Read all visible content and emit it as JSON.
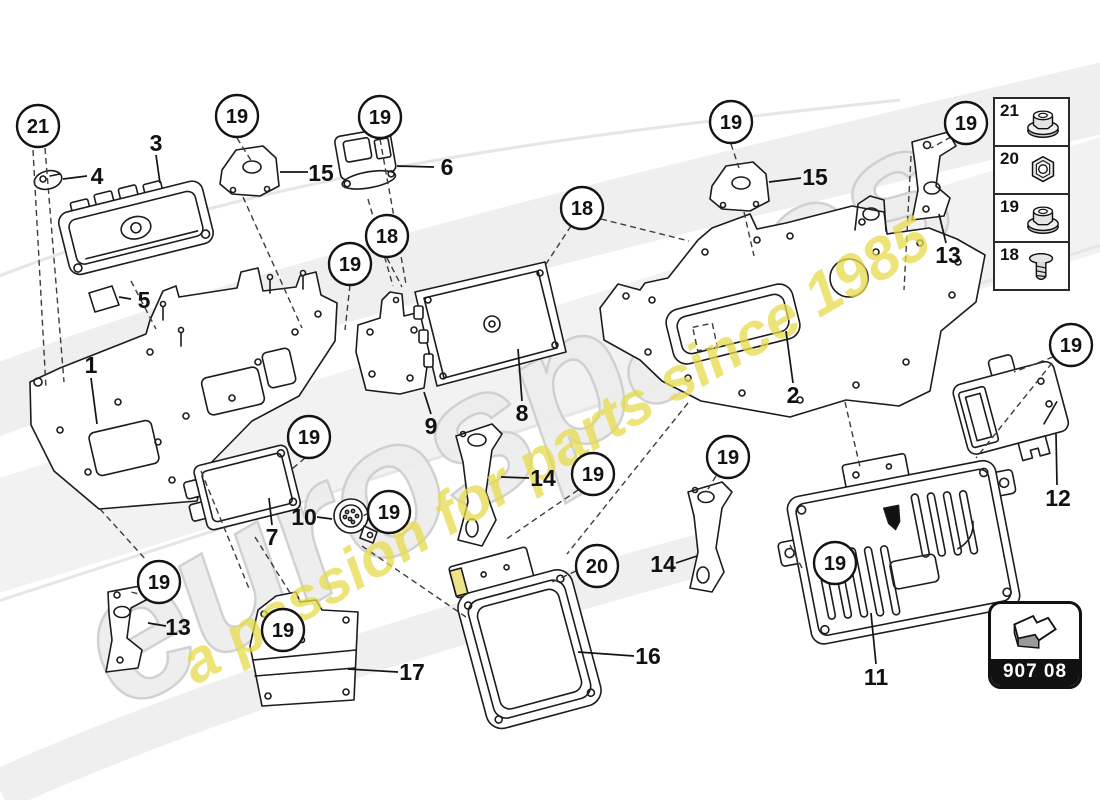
{
  "watermark": {
    "brand": "eurospares",
    "tagline": "a passion for parts since 1985"
  },
  "badge": {
    "code": "907 08"
  },
  "legend": {
    "rows": [
      {
        "number": "21",
        "icon": "flange-nut"
      },
      {
        "number": "20",
        "icon": "hex-nut"
      },
      {
        "number": "19",
        "icon": "flange-nut"
      },
      {
        "number": "18",
        "icon": "screw"
      }
    ]
  },
  "diagram": {
    "callouts": [
      {
        "number": "21",
        "x": 38,
        "y": 126
      },
      {
        "number": "19",
        "x": 237,
        "y": 116
      },
      {
        "number": "19",
        "x": 380,
        "y": 117
      },
      {
        "number": "19",
        "x": 731,
        "y": 122
      },
      {
        "number": "19",
        "x": 966,
        "y": 123
      },
      {
        "number": "18",
        "x": 387,
        "y": 236
      },
      {
        "number": "18",
        "x": 582,
        "y": 208
      },
      {
        "number": "19",
        "x": 350,
        "y": 264
      },
      {
        "number": "19",
        "x": 309,
        "y": 437
      },
      {
        "number": "19",
        "x": 1071,
        "y": 345
      },
      {
        "number": "19",
        "x": 593,
        "y": 474
      },
      {
        "number": "19",
        "x": 728,
        "y": 457
      },
      {
        "number": "19",
        "x": 389,
        "y": 512
      },
      {
        "number": "20",
        "x": 597,
        "y": 566
      },
      {
        "number": "19",
        "x": 835,
        "y": 563
      },
      {
        "number": "19",
        "x": 159,
        "y": 582
      },
      {
        "number": "19",
        "x": 283,
        "y": 630
      }
    ],
    "labels": [
      {
        "text": "3",
        "x": 156,
        "y": 143,
        "leader": [
          156,
          155,
          160,
          183
        ]
      },
      {
        "text": "4",
        "x": 97,
        "y": 176,
        "leader": [
          87,
          176,
          63,
          179
        ]
      },
      {
        "text": "15",
        "x": 321,
        "y": 173,
        "leader": [
          308,
          172,
          280,
          172
        ]
      },
      {
        "text": "6",
        "x": 447,
        "y": 167,
        "leader": [
          434,
          167,
          397,
          166
        ]
      },
      {
        "text": "5",
        "x": 144,
        "y": 300,
        "leader": [
          131,
          299,
          119,
          297
        ]
      },
      {
        "text": "1",
        "x": 91,
        "y": 365,
        "leader": [
          91,
          378,
          97,
          424
        ]
      },
      {
        "text": "15",
        "x": 815,
        "y": 177,
        "leader": [
          801,
          178,
          769,
          182
        ]
      },
      {
        "text": "13",
        "x": 948,
        "y": 255,
        "leader": [
          946,
          243,
          939,
          214
        ]
      },
      {
        "text": "2",
        "x": 793,
        "y": 395,
        "leader": [
          793,
          383,
          786,
          331
        ]
      },
      {
        "text": "8",
        "x": 522,
        "y": 413,
        "leader": [
          522,
          401,
          518,
          349
        ]
      },
      {
        "text": "9",
        "x": 431,
        "y": 426,
        "leader": [
          431,
          414,
          424,
          392
        ]
      },
      {
        "text": "7",
        "x": 272,
        "y": 537,
        "leader": [
          272,
          525,
          269,
          498
        ]
      },
      {
        "text": "10",
        "x": 304,
        "y": 517,
        "leader": [
          317,
          517,
          332,
          519
        ]
      },
      {
        "text": "14",
        "x": 543,
        "y": 478,
        "leader": [
          529,
          478,
          501,
          477
        ]
      },
      {
        "text": "13",
        "x": 178,
        "y": 627,
        "leader": [
          166,
          626,
          148,
          623
        ]
      },
      {
        "text": "17",
        "x": 412,
        "y": 672,
        "leader": [
          398,
          672,
          348,
          669
        ]
      },
      {
        "text": "16",
        "x": 648,
        "y": 656,
        "leader": [
          634,
          656,
          578,
          652
        ]
      },
      {
        "text": "14",
        "x": 663,
        "y": 564,
        "leader": [
          676,
          563,
          697,
          556
        ]
      },
      {
        "text": "11",
        "x": 876,
        "y": 677,
        "leader": [
          876,
          664,
          871,
          613
        ]
      },
      {
        "text": "12",
        "x": 1058,
        "y": 498,
        "leader": [
          1057,
          485,
          1056,
          434
        ]
      }
    ],
    "dashed_lines": [
      [
        33,
        150,
        46,
        388
      ],
      [
        45,
        148,
        64,
        382
      ],
      [
        237,
        138,
        252,
        162
      ],
      [
        243,
        197,
        302,
        328
      ],
      [
        380,
        139,
        406,
        284
      ],
      [
        387,
        258,
        402,
        287
      ],
      [
        350,
        285,
        345,
        330
      ],
      [
        571,
        226,
        546,
        264
      ],
      [
        601,
        219,
        689,
        241
      ],
      [
        731,
        144,
        739,
        168
      ],
      [
        744,
        212,
        754,
        256
      ],
      [
        951,
        137,
        931,
        148
      ],
      [
        911,
        156,
        904,
        290
      ],
      [
        1053,
        357,
        1014,
        372
      ],
      [
        1052,
        363,
        976,
        458
      ],
      [
        576,
        571,
        550,
        583
      ],
      [
        578,
        490,
        505,
        540
      ],
      [
        790,
        545,
        802,
        568
      ],
      [
        305,
        458,
        292,
        469
      ],
      [
        369,
        513,
        361,
        517
      ],
      [
        716,
        476,
        708,
        489
      ],
      [
        147,
        596,
        131,
        592
      ],
      [
        255,
        537,
        292,
        596
      ],
      [
        362,
        546,
        466,
        617
      ],
      [
        368,
        199,
        393,
        286
      ],
      [
        131,
        281,
        156,
        329
      ],
      [
        100,
        509,
        147,
        561
      ],
      [
        201,
        471,
        250,
        591
      ],
      [
        845,
        402,
        860,
        467
      ],
      [
        688,
        403,
        567,
        554
      ]
    ]
  },
  "colors": {
    "line": "#1c1c1c",
    "watermark_gray": "#ededed",
    "watermark_yellow": "#e7dc4d",
    "badge_bar": "#111111"
  }
}
